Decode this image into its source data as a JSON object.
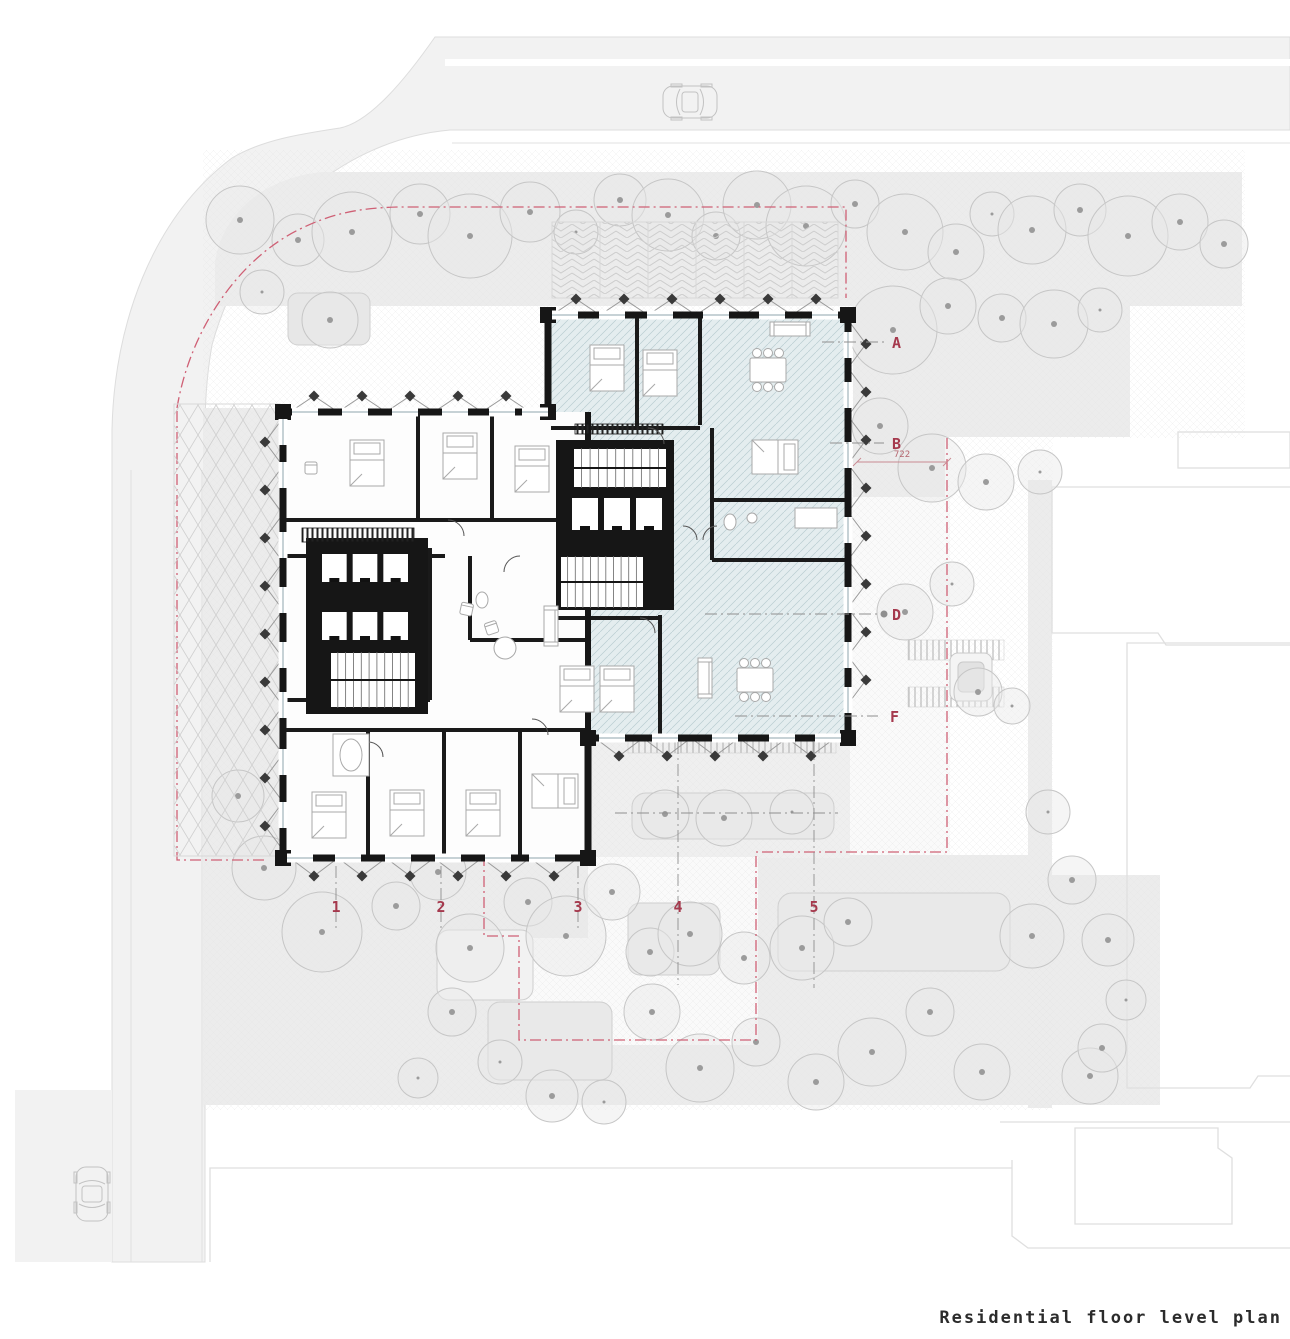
{
  "drawing": {
    "title": "Residential floor level plan"
  },
  "grid": {
    "row_labels": [
      "A",
      "B",
      "D",
      "F"
    ],
    "col_labels": [
      "1",
      "2",
      "3",
      "4",
      "5"
    ]
  },
  "dimensions": {
    "east_offset": "722"
  },
  "colors": {
    "marker_red": "#a5394d",
    "boundary_red": "#cf6075",
    "wall_black": "#161616",
    "unit_tint_blue": "#e4edef",
    "site_gray": "#ececec",
    "road_gray": "#f2f2f2"
  }
}
